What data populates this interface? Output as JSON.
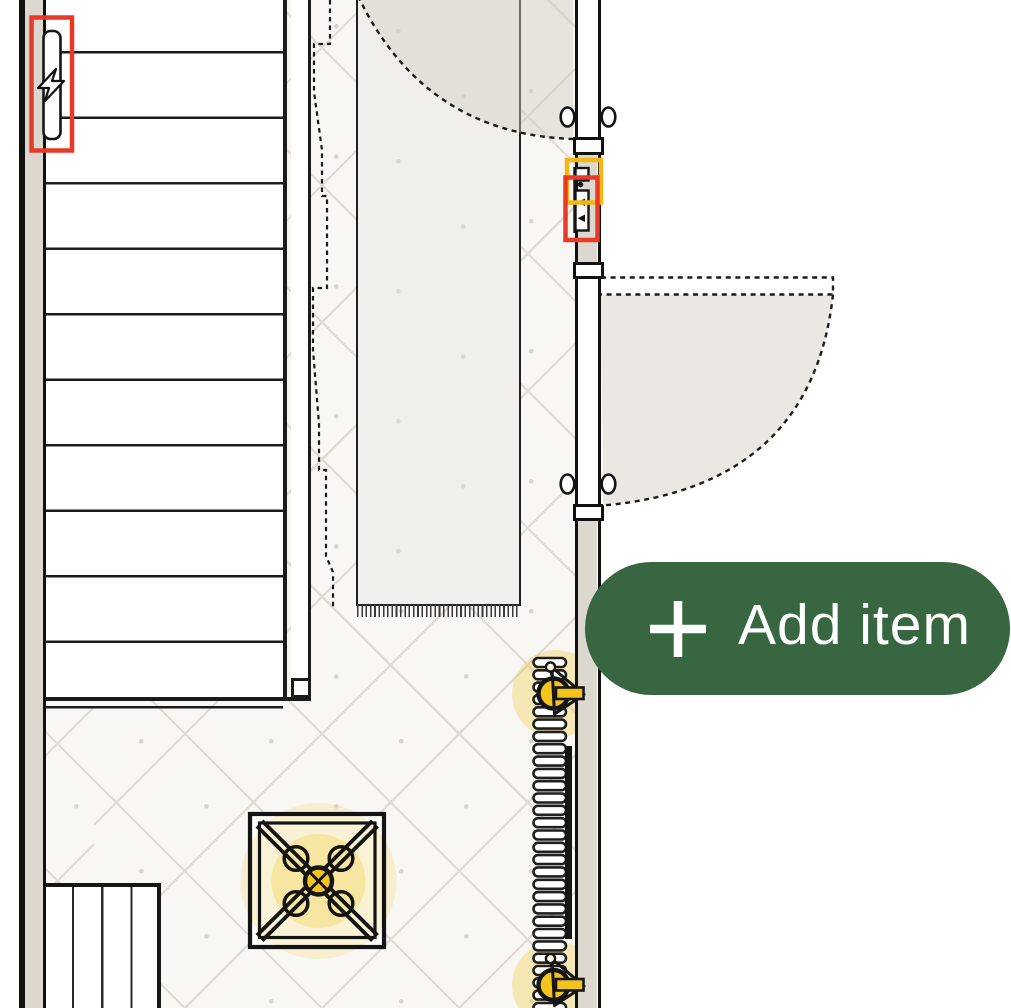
{
  "app": {
    "view": "floor-plan-editor"
  },
  "add_item_button": {
    "label": "Add item",
    "icon": "plus"
  },
  "colors": {
    "accent_green": "#386640",
    "highlight_red": "#E93A28",
    "highlight_yellow": "#F3B617",
    "symbol_yellow": "#F4C41E",
    "wall_fill": "#DCD8CF",
    "floor_bg": "#F8F7F4",
    "tile_line": "#DFDAD3",
    "rug_fill": "#F1EFEC",
    "door_swing_fill": "#EBE8E3"
  },
  "radiator": {
    "sections": 29
  },
  "stairs": {
    "treads": 10
  },
  "symbols": {
    "electrical_panel": "lightning-bolt",
    "wall_switch": "two-way-switch",
    "ceiling_light": "four-bulb-fixture",
    "radiator": "finned-radiator-with-valves"
  }
}
